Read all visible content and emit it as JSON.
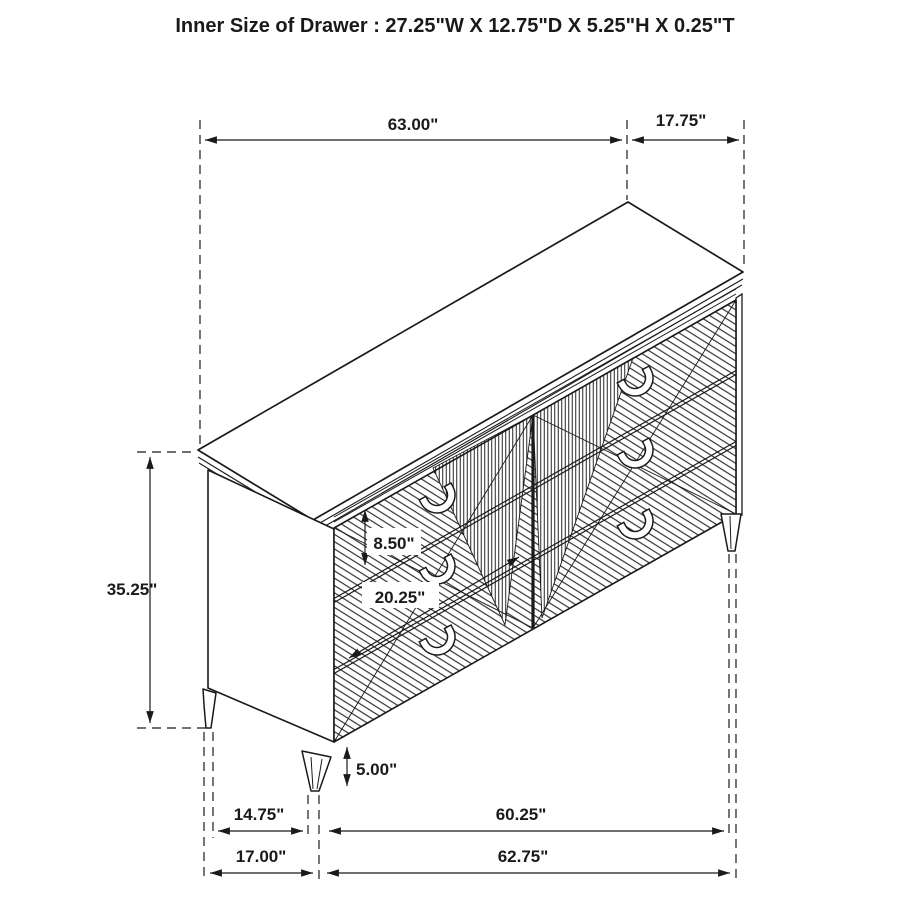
{
  "title": "Inner Size of Drawer : 27.25\"W X 12.75\"D X 5.25\"H X 0.25\"T",
  "dimensions": {
    "top_width": "63.00\"",
    "top_depth": "17.75\"",
    "overall_height": "35.25\"",
    "drawer_front_height": "8.50\"",
    "drawer_width": "20.25\"",
    "leg_height": "5.00\"",
    "leg_inset_depth": "14.75\"",
    "leg_span_front": "60.25\"",
    "base_depth": "17.00\"",
    "base_width": "62.75\""
  },
  "colors": {
    "line": "#1a1a1a",
    "background": "#ffffff"
  }
}
